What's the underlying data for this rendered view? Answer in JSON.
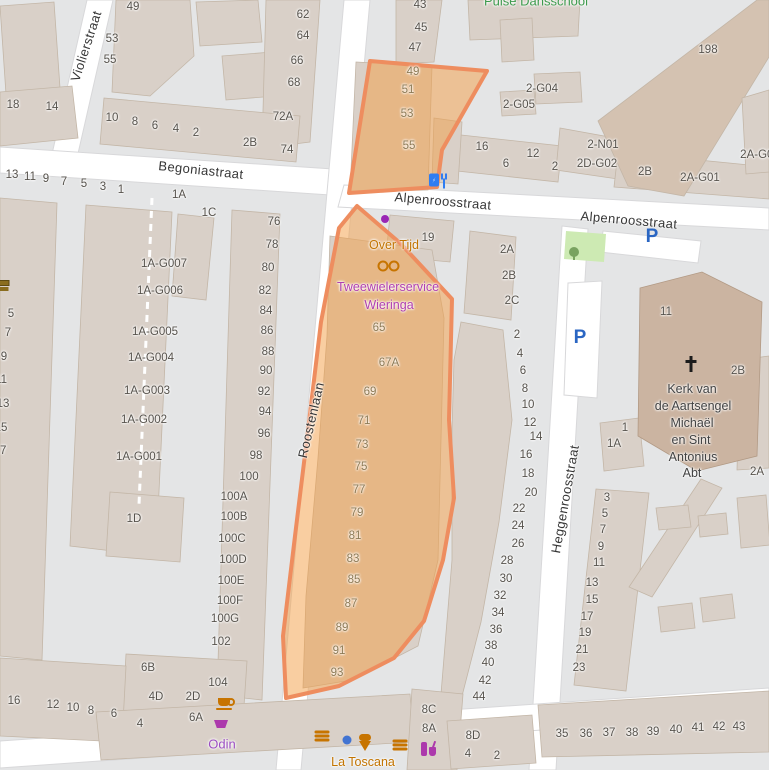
{
  "highlight": {
    "fill": "#f49e43",
    "fill_opacity": 0.5,
    "stroke": "#ee8d5f"
  },
  "colors": {
    "road": "#ffffff",
    "block": "#e4e5e6",
    "building": "#d9d0c8",
    "building_dark": "#cbb4a1",
    "parking_blue": "#2a66c3",
    "grass": "#cdeab3"
  },
  "streets": [
    "Violierstraat",
    "Begoniastraat",
    "Alpenroosstraat",
    "Roostenlaan",
    "Heggenroosstraat"
  ],
  "pois": [
    "Pulse Dansschool",
    "Over Tijd",
    "Tweewielerservice Wieringa",
    "Odin",
    "La Toscana",
    "Kerk van de Aartsengel Michaël en Sint Antonius Abt"
  ],
  "labels": [
    {
      "t": "Violierstraat",
      "x": 86,
      "y": 46,
      "r": -72,
      "c": "street",
      "n": "street-label-violierstraat"
    },
    {
      "t": "Begoniastraat",
      "x": 201,
      "y": 170,
      "r": 6,
      "c": "street",
      "n": "street-label-begoniastraat"
    },
    {
      "t": "Alpenroosstraat",
      "x": 443,
      "y": 201,
      "r": 5,
      "c": "street",
      "n": "street-label-alpenroosstraat"
    },
    {
      "t": "Alpenroosstraat",
      "x": 629,
      "y": 220,
      "r": 5,
      "c": "street",
      "n": "street-label-alpenroosstraat"
    },
    {
      "t": "Roostenlaan",
      "x": 311,
      "y": 420,
      "r": -77,
      "c": "street",
      "n": "street-label-roostenlaan"
    },
    {
      "t": "Heggenroosstraat",
      "x": 565,
      "y": 499,
      "r": -80,
      "c": "street",
      "n": "street-label-heggenroosstraat"
    },
    {
      "t": "Pulse Dansschool",
      "x": 536,
      "y": 1,
      "c": "poig",
      "n": "poi-label-pulse-dansschool"
    },
    {
      "t": "Over Tijd",
      "x": 394,
      "y": 245,
      "c": "poio",
      "n": "poi-label-over-tijd"
    },
    {
      "t": "Tweewielerservice",
      "x": 388,
      "y": 287,
      "c": "poim",
      "n": "poi-label-tweewielerservice"
    },
    {
      "t": "Wieringa",
      "x": 389,
      "y": 305,
      "c": "poim",
      "n": "poi-label-tweewielerservice"
    },
    {
      "t": "Odin",
      "x": 222,
      "y": 744,
      "c": "poip",
      "n": "poi-label-odin"
    },
    {
      "t": "La Toscana",
      "x": 363,
      "y": 762,
      "c": "poio",
      "n": "poi-label-la-toscana"
    },
    {
      "t": "Kerk van",
      "x": 692,
      "y": 389,
      "c": "church",
      "n": "church-label"
    },
    {
      "t": "de Aartsengel",
      "x": 693,
      "y": 406,
      "c": "church",
      "n": "church-label"
    },
    {
      "t": "Michaël",
      "x": 692,
      "y": 423,
      "c": "church",
      "n": "church-label"
    },
    {
      "t": "en Sint",
      "x": 691,
      "y": 440,
      "c": "church",
      "n": "church-label"
    },
    {
      "t": "Antonius",
      "x": 693,
      "y": 457,
      "c": "church",
      "n": "church-label"
    },
    {
      "t": "Abt",
      "x": 692,
      "y": 473,
      "c": "church",
      "n": "church-label"
    },
    {
      "t": "P",
      "x": 652,
      "y": 237,
      "c": "park",
      "n": "parking-icon"
    },
    {
      "t": "P",
      "x": 580,
      "y": 338,
      "c": "park",
      "n": "parking-icon"
    },
    {
      "t": "49",
      "x": 133,
      "y": 7
    },
    {
      "t": "53",
      "x": 112,
      "y": 39
    },
    {
      "t": "55",
      "x": 110,
      "y": 60
    },
    {
      "t": "62",
      "x": 303,
      "y": 15
    },
    {
      "t": "64",
      "x": 303,
      "y": 36
    },
    {
      "t": "66",
      "x": 297,
      "y": 61
    },
    {
      "t": "68",
      "x": 294,
      "y": 83
    },
    {
      "t": "72A",
      "x": 283,
      "y": 117
    },
    {
      "t": "2B",
      "x": 250,
      "y": 143
    },
    {
      "t": "74",
      "x": 287,
      "y": 150
    },
    {
      "t": "18",
      "x": 13,
      "y": 105
    },
    {
      "t": "14",
      "x": 52,
      "y": 107
    },
    {
      "t": "10",
      "x": 112,
      "y": 118
    },
    {
      "t": "8",
      "x": 135,
      "y": 122
    },
    {
      "t": "6",
      "x": 155,
      "y": 126
    },
    {
      "t": "4",
      "x": 176,
      "y": 129
    },
    {
      "t": "2",
      "x": 196,
      "y": 133
    },
    {
      "t": "13",
      "x": 12,
      "y": 175
    },
    {
      "t": "11",
      "x": 30,
      "y": 177
    },
    {
      "t": "9",
      "x": 46,
      "y": 179
    },
    {
      "t": "7",
      "x": 64,
      "y": 182
    },
    {
      "t": "5",
      "x": 84,
      "y": 184
    },
    {
      "t": "3",
      "x": 103,
      "y": 187
    },
    {
      "t": "1",
      "x": 121,
      "y": 190
    },
    {
      "t": "1A",
      "x": 179,
      "y": 195
    },
    {
      "t": "1C",
      "x": 209,
      "y": 213
    },
    {
      "t": "43",
      "x": 420,
      "y": 5
    },
    {
      "t": "45",
      "x": 421,
      "y": 28
    },
    {
      "t": "47",
      "x": 415,
      "y": 48
    },
    {
      "t": "49",
      "x": 413,
      "y": 72,
      "c": "numm"
    },
    {
      "t": "51",
      "x": 408,
      "y": 90,
      "c": "numm"
    },
    {
      "t": "53",
      "x": 407,
      "y": 114,
      "c": "numm"
    },
    {
      "t": "55",
      "x": 409,
      "y": 146,
      "c": "numm"
    },
    {
      "t": "2-G04",
      "x": 542,
      "y": 89
    },
    {
      "t": "2-G05",
      "x": 519,
      "y": 105
    },
    {
      "t": "198",
      "x": 708,
      "y": 50
    },
    {
      "t": "16",
      "x": 482,
      "y": 147
    },
    {
      "t": "12",
      "x": 533,
      "y": 154
    },
    {
      "t": "6",
      "x": 506,
      "y": 164
    },
    {
      "t": "2",
      "x": 555,
      "y": 167
    },
    {
      "t": "2-N01",
      "x": 603,
      "y": 145
    },
    {
      "t": "2D-G02",
      "x": 597,
      "y": 164
    },
    {
      "t": "2B",
      "x": 645,
      "y": 172
    },
    {
      "t": "2A-G01",
      "x": 700,
      "y": 178
    },
    {
      "t": "2A-G02",
      "x": 760,
      "y": 155
    },
    {
      "t": "76",
      "x": 274,
      "y": 222
    },
    {
      "t": "78",
      "x": 272,
      "y": 245
    },
    {
      "t": "80",
      "x": 268,
      "y": 268
    },
    {
      "t": "82",
      "x": 265,
      "y": 291
    },
    {
      "t": "84",
      "x": 266,
      "y": 311
    },
    {
      "t": "86",
      "x": 267,
      "y": 331
    },
    {
      "t": "88",
      "x": 268,
      "y": 352
    },
    {
      "t": "90",
      "x": 266,
      "y": 371
    },
    {
      "t": "92",
      "x": 264,
      "y": 392
    },
    {
      "t": "94",
      "x": 265,
      "y": 412
    },
    {
      "t": "96",
      "x": 264,
      "y": 434
    },
    {
      "t": "98",
      "x": 256,
      "y": 456
    },
    {
      "t": "100",
      "x": 249,
      "y": 477
    },
    {
      "t": "100A",
      "x": 234,
      "y": 497
    },
    {
      "t": "100B",
      "x": 234,
      "y": 517
    },
    {
      "t": "100C",
      "x": 232,
      "y": 539
    },
    {
      "t": "100D",
      "x": 233,
      "y": 560
    },
    {
      "t": "100E",
      "x": 231,
      "y": 581
    },
    {
      "t": "100F",
      "x": 230,
      "y": 601
    },
    {
      "t": "100G",
      "x": 225,
      "y": 619
    },
    {
      "t": "102",
      "x": 221,
      "y": 642
    },
    {
      "t": "104",
      "x": 218,
      "y": 683
    },
    {
      "t": "6B",
      "x": 148,
      "y": 668
    },
    {
      "t": "4D",
      "x": 156,
      "y": 697
    },
    {
      "t": "2D",
      "x": 193,
      "y": 697
    },
    {
      "t": "6A",
      "x": 196,
      "y": 718
    },
    {
      "t": "4",
      "x": 140,
      "y": 724
    },
    {
      "t": "16",
      "x": 14,
      "y": 701
    },
    {
      "t": "12",
      "x": 53,
      "y": 705
    },
    {
      "t": "10",
      "x": 73,
      "y": 708
    },
    {
      "t": "8",
      "x": 91,
      "y": 711
    },
    {
      "t": "6",
      "x": 114,
      "y": 714
    },
    {
      "t": "1A-G007",
      "x": 164,
      "y": 264
    },
    {
      "t": "1A-G006",
      "x": 160,
      "y": 291
    },
    {
      "t": "1A-G005",
      "x": 155,
      "y": 332
    },
    {
      "t": "1A-G004",
      "x": 151,
      "y": 358
    },
    {
      "t": "1A-G003",
      "x": 147,
      "y": 391
    },
    {
      "t": "1A-G002",
      "x": 144,
      "y": 420
    },
    {
      "t": "1A-G001",
      "x": 139,
      "y": 457
    },
    {
      "t": "1D",
      "x": 134,
      "y": 519
    },
    {
      "t": "5",
      "x": 11,
      "y": 314
    },
    {
      "t": "7",
      "x": 8,
      "y": 333
    },
    {
      "t": "9",
      "x": 4,
      "y": 357
    },
    {
      "t": "11",
      "x": 1,
      "y": 380
    },
    {
      "t": "13",
      "x": 3,
      "y": 404
    },
    {
      "t": "15",
      "x": 1,
      "y": 428
    },
    {
      "t": "17",
      "x": 0,
      "y": 451
    },
    {
      "t": "19",
      "x": 428,
      "y": 238
    },
    {
      "t": "2A",
      "x": 507,
      "y": 250
    },
    {
      "t": "2B",
      "x": 509,
      "y": 276
    },
    {
      "t": "2C",
      "x": 512,
      "y": 301
    },
    {
      "t": "2",
      "x": 517,
      "y": 335
    },
    {
      "t": "4",
      "x": 520,
      "y": 354
    },
    {
      "t": "6",
      "x": 523,
      "y": 371
    },
    {
      "t": "8",
      "x": 525,
      "y": 389
    },
    {
      "t": "10",
      "x": 528,
      "y": 405
    },
    {
      "t": "12",
      "x": 530,
      "y": 423
    },
    {
      "t": "14",
      "x": 536,
      "y": 437
    },
    {
      "t": "16",
      "x": 526,
      "y": 455
    },
    {
      "t": "18",
      "x": 528,
      "y": 474
    },
    {
      "t": "20",
      "x": 531,
      "y": 493
    },
    {
      "t": "22",
      "x": 519,
      "y": 509
    },
    {
      "t": "24",
      "x": 518,
      "y": 526
    },
    {
      "t": "26",
      "x": 518,
      "y": 544
    },
    {
      "t": "28",
      "x": 507,
      "y": 561
    },
    {
      "t": "30",
      "x": 506,
      "y": 579
    },
    {
      "t": "32",
      "x": 500,
      "y": 596
    },
    {
      "t": "34",
      "x": 498,
      "y": 613
    },
    {
      "t": "36",
      "x": 496,
      "y": 630
    },
    {
      "t": "38",
      "x": 491,
      "y": 646
    },
    {
      "t": "40",
      "x": 488,
      "y": 663
    },
    {
      "t": "42",
      "x": 485,
      "y": 681
    },
    {
      "t": "44",
      "x": 479,
      "y": 697
    },
    {
      "t": "8C",
      "x": 429,
      "y": 710
    },
    {
      "t": "8A",
      "x": 429,
      "y": 729
    },
    {
      "t": "8D",
      "x": 473,
      "y": 736
    },
    {
      "t": "4",
      "x": 468,
      "y": 754
    },
    {
      "t": "2",
      "x": 497,
      "y": 756
    },
    {
      "t": "65",
      "x": 379,
      "y": 328,
      "c": "numm"
    },
    {
      "t": "67A",
      "x": 389,
      "y": 363,
      "c": "numm"
    },
    {
      "t": "69",
      "x": 370,
      "y": 392,
      "c": "numm"
    },
    {
      "t": "71",
      "x": 364,
      "y": 421,
      "c": "numm"
    },
    {
      "t": "73",
      "x": 362,
      "y": 445,
      "c": "numm"
    },
    {
      "t": "75",
      "x": 361,
      "y": 467,
      "c": "numm"
    },
    {
      "t": "77",
      "x": 359,
      "y": 490,
      "c": "numm"
    },
    {
      "t": "79",
      "x": 357,
      "y": 513,
      "c": "numm"
    },
    {
      "t": "81",
      "x": 355,
      "y": 536,
      "c": "numm"
    },
    {
      "t": "83",
      "x": 353,
      "y": 559,
      "c": "numm"
    },
    {
      "t": "85",
      "x": 354,
      "y": 580,
      "c": "numm"
    },
    {
      "t": "87",
      "x": 351,
      "y": 604,
      "c": "numm"
    },
    {
      "t": "89",
      "x": 342,
      "y": 628,
      "c": "numm"
    },
    {
      "t": "91",
      "x": 339,
      "y": 651,
      "c": "numm"
    },
    {
      "t": "93",
      "x": 337,
      "y": 673,
      "c": "numm"
    },
    {
      "t": "11",
      "x": 666,
      "y": 312
    },
    {
      "t": "2B",
      "x": 738,
      "y": 371
    },
    {
      "t": "1",
      "x": 625,
      "y": 428
    },
    {
      "t": "1A",
      "x": 614,
      "y": 444
    },
    {
      "t": "2A",
      "x": 757,
      "y": 472
    },
    {
      "t": "3",
      "x": 607,
      "y": 498
    },
    {
      "t": "5",
      "x": 605,
      "y": 514
    },
    {
      "t": "7",
      "x": 603,
      "y": 530
    },
    {
      "t": "9",
      "x": 601,
      "y": 547
    },
    {
      "t": "11",
      "x": 599,
      "y": 563
    },
    {
      "t": "13",
      "x": 592,
      "y": 583
    },
    {
      "t": "15",
      "x": 592,
      "y": 600
    },
    {
      "t": "17",
      "x": 587,
      "y": 617
    },
    {
      "t": "19",
      "x": 585,
      "y": 633
    },
    {
      "t": "21",
      "x": 582,
      "y": 650
    },
    {
      "t": "23",
      "x": 579,
      "y": 668
    },
    {
      "t": "35",
      "x": 562,
      "y": 734
    },
    {
      "t": "36",
      "x": 586,
      "y": 734
    },
    {
      "t": "37",
      "x": 609,
      "y": 733
    },
    {
      "t": "38",
      "x": 632,
      "y": 733
    },
    {
      "t": "39",
      "x": 653,
      "y": 732
    },
    {
      "t": "40",
      "x": 676,
      "y": 730
    },
    {
      "t": "41",
      "x": 698,
      "y": 728
    },
    {
      "t": "42",
      "x": 719,
      "y": 727
    },
    {
      "t": "43",
      "x": 739,
      "y": 727
    }
  ],
  "icons": [
    {
      "k": "books",
      "x": 3,
      "y": 283
    },
    {
      "k": "ev",
      "x": 434,
      "y": 180
    },
    {
      "k": "dot-purple",
      "x": 385,
      "y": 219
    },
    {
      "k": "bike",
      "x": 388,
      "y": 266
    },
    {
      "k": "tree",
      "x": 574,
      "y": 252
    },
    {
      "k": "cross",
      "x": 691,
      "y": 364
    },
    {
      "k": "coffee",
      "x": 224,
      "y": 702
    },
    {
      "k": "basket",
      "x": 221,
      "y": 724
    },
    {
      "k": "burger",
      "x": 322,
      "y": 737
    },
    {
      "k": "dot-blue",
      "x": 347,
      "y": 740
    },
    {
      "k": "icecream",
      "x": 365,
      "y": 743
    },
    {
      "k": "burger",
      "x": 400,
      "y": 746
    },
    {
      "k": "drinks",
      "x": 424,
      "y": 749
    }
  ]
}
